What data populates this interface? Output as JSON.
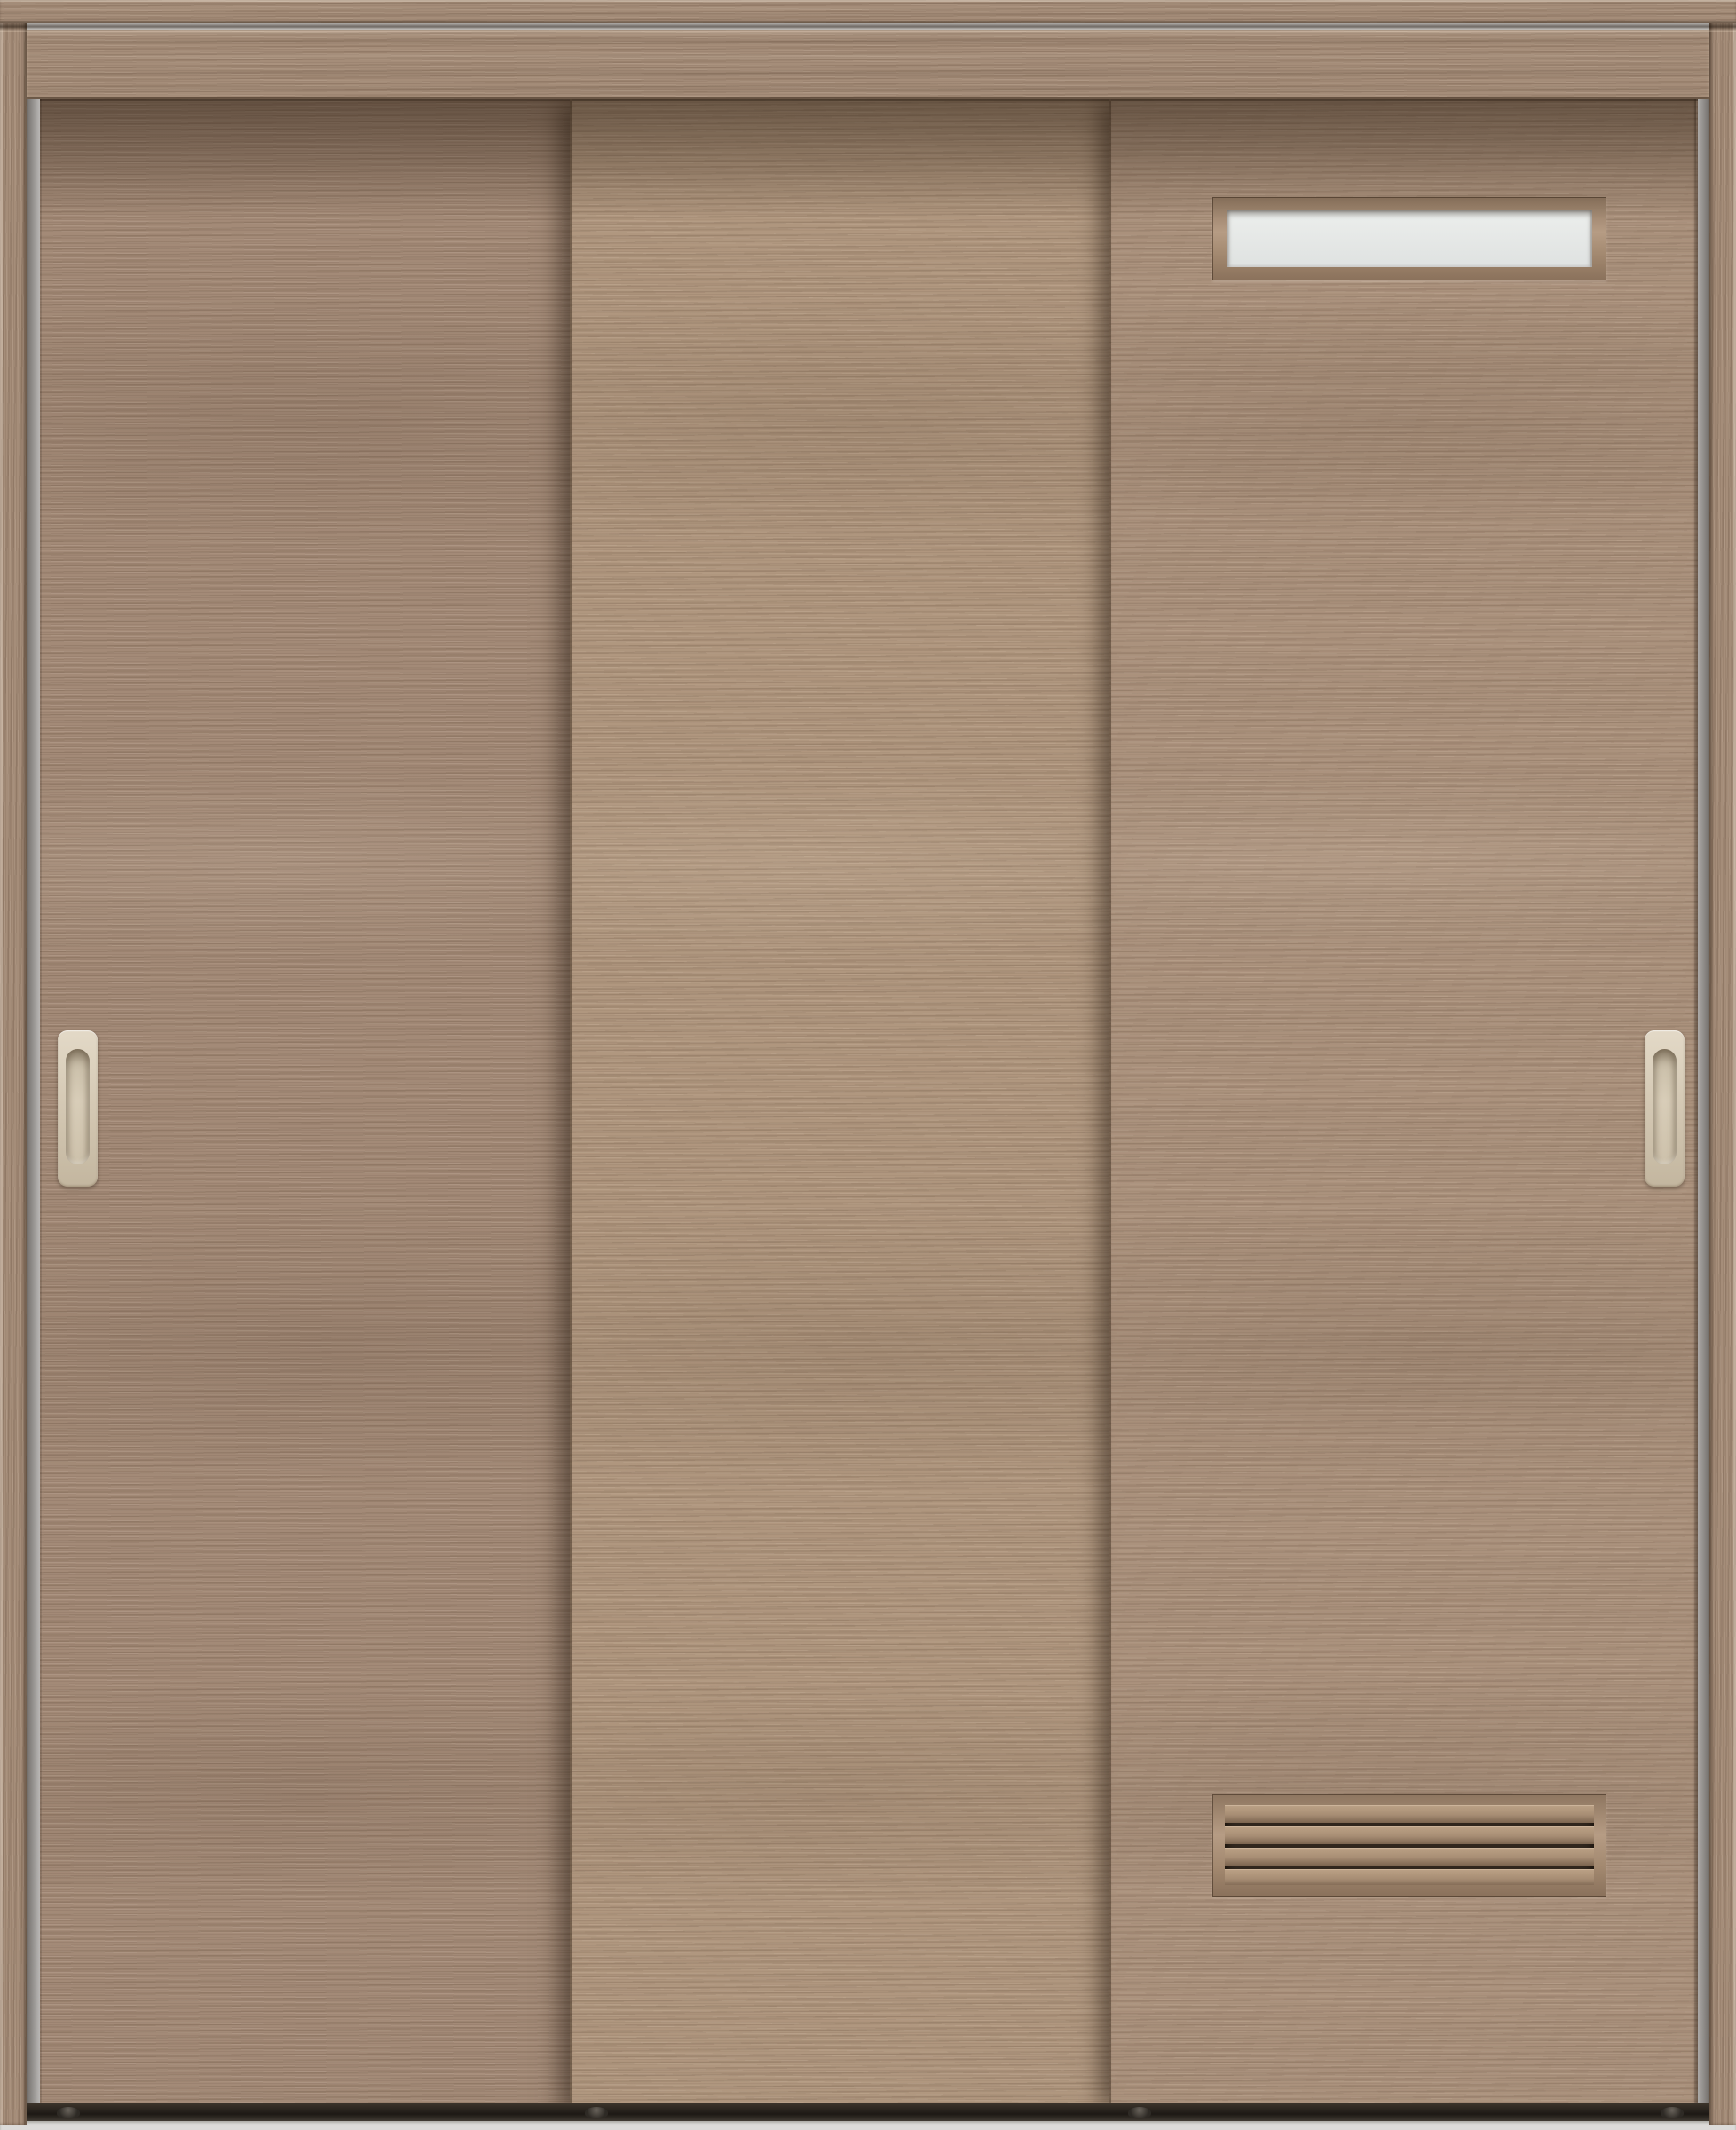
{
  "meta": {
    "description": "Product photograph of a three-panel wooden interior sliding door unit in a light grey-brown walnut woodgrain finish, shown front-on inside its frame",
    "image_type": "product-photo",
    "text_content": "none"
  },
  "unit": {
    "frame": {
      "parts": [
        "top-casing",
        "header-board",
        "left-jamb",
        "right-jamb",
        "floor-track"
      ],
      "finish": "matching woodgrain"
    },
    "panels": [
      {
        "id": "left",
        "position": "rear track, left",
        "features": [
          "recessed-pull-handle"
        ]
      },
      {
        "id": "middle",
        "position": "middle track, center",
        "features": []
      },
      {
        "id": "right",
        "position": "front track, right",
        "features": [
          "frosted-slit-window",
          "louver-vent",
          "recessed-pull-handle"
        ]
      }
    ],
    "slit_window": {
      "shape": "narrow horizontal rectangle",
      "glazing": "frosted glass",
      "frame": "beveled wood",
      "location": "upper area of right panel"
    },
    "louver_vent": {
      "slat_count": 4,
      "orientation": "horizontal",
      "frame": "beveled wood",
      "location": "lower area of right panel"
    },
    "handles": {
      "type": "recessed oval pull",
      "color_name": "ivory/beige",
      "count": 2
    },
    "floor_guides": {
      "count": 4
    }
  },
  "colors": {
    "frame_wood": "#a58d79",
    "wood_left": "#a38a77",
    "wood_middle": "#b0977f",
    "wood_right": "#ab927d",
    "glass": "#eceeec",
    "handle": "#d6cbb7",
    "vent_gap": "#30261d",
    "track": "#2b251f",
    "floor": "#dcdbd9"
  }
}
